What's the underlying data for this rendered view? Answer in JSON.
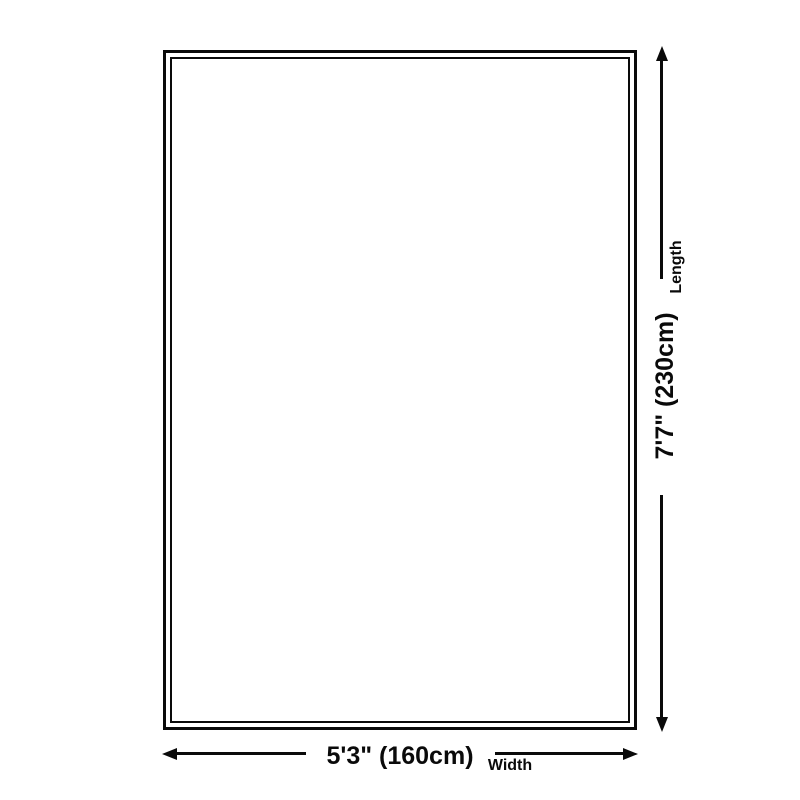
{
  "diagram": {
    "type": "rug-size-dimension-diagram",
    "colors": {
      "background": "#ffffff",
      "ink": "#0a0a0a"
    },
    "icons": {
      "arrow_up": "css-triangle-up",
      "arrow_down": "css-triangle-down",
      "arrow_left": "css-triangle-left",
      "arrow_right": "css-triangle-right"
    },
    "dimensions": {
      "length": {
        "label": "Length",
        "value": "7'7\" (230cm)"
      },
      "width": {
        "label": "Width",
        "value": "5'3\" (160cm)"
      }
    }
  }
}
